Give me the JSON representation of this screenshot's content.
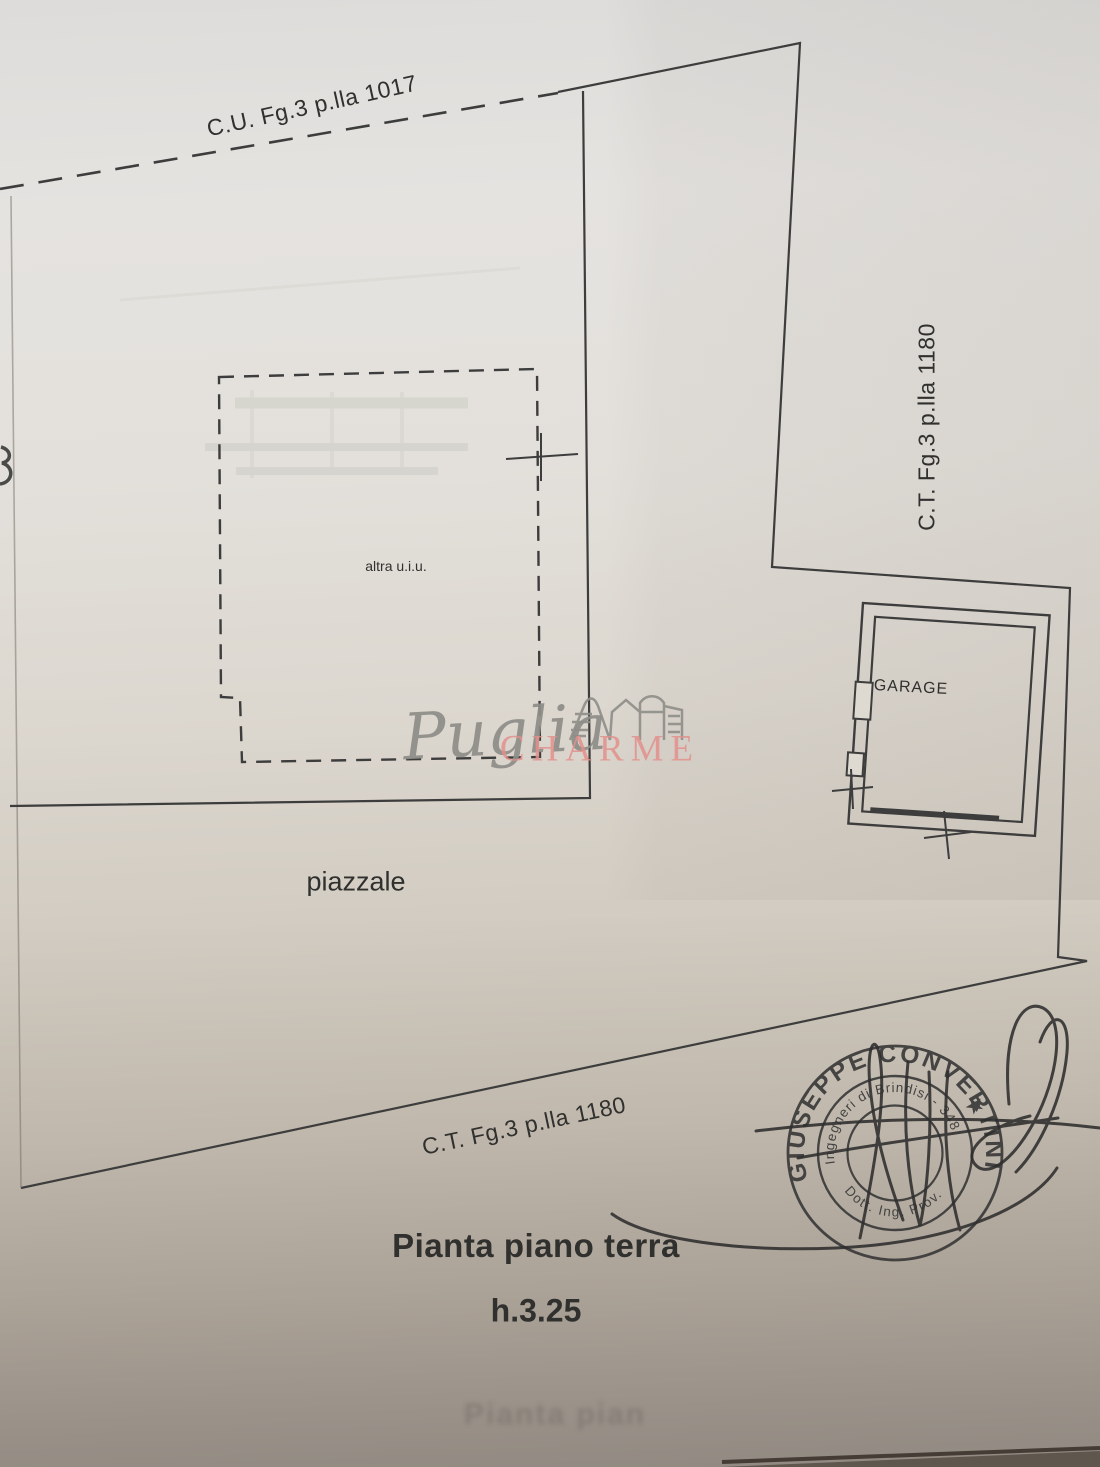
{
  "plan": {
    "parcel_label_top": "C.U. Fg.3 p.lla 1017",
    "parcel_label_right": "C.T. Fg.3 p.lla 1180",
    "parcel_label_bottom": "C.T. Fg.3 p.lla 1180",
    "room_garage_label": "GARAGE",
    "area_other_unit_label": "altra u.i.u.",
    "area_yard_label": "piazzale",
    "title": "Pianta piano terra",
    "height_annotation": "h.3.25",
    "ghost_title_bleed": "Pianta pian"
  },
  "watermark": {
    "script_word": "Puglia",
    "caps_word": "CHARME",
    "script_color": "#8e8d88",
    "caps_color": "#e2908b"
  },
  "stamp": {
    "outer_ring_text": "GIUSEPPE CONVERTINI",
    "star_glyph": "★",
    "inner_ring_text_top": "Ingegneri di Brindisi - 348",
    "inner_ring_text_bottom": "Dott. Ing. Prov.",
    "ink_color": "#3a3a3a"
  },
  "paper": {
    "top_color": "#e3e1dd",
    "bottom_color": "#9a938b",
    "line_color": "#3d3d3d"
  }
}
